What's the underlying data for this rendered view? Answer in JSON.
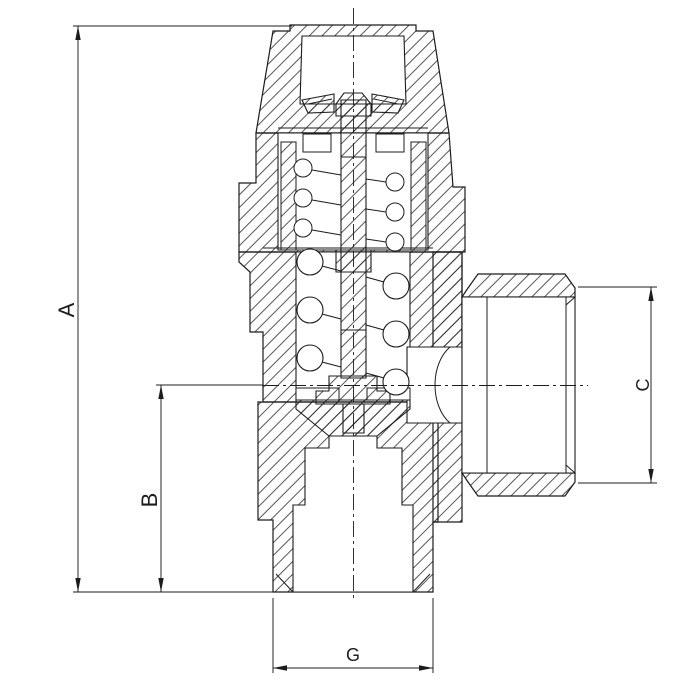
{
  "drawing": {
    "background": "#ffffff",
    "line_color": "#1c1c1c",
    "dimensions": {
      "a": "A",
      "b": "B",
      "c": "C",
      "g": "G"
    }
  }
}
